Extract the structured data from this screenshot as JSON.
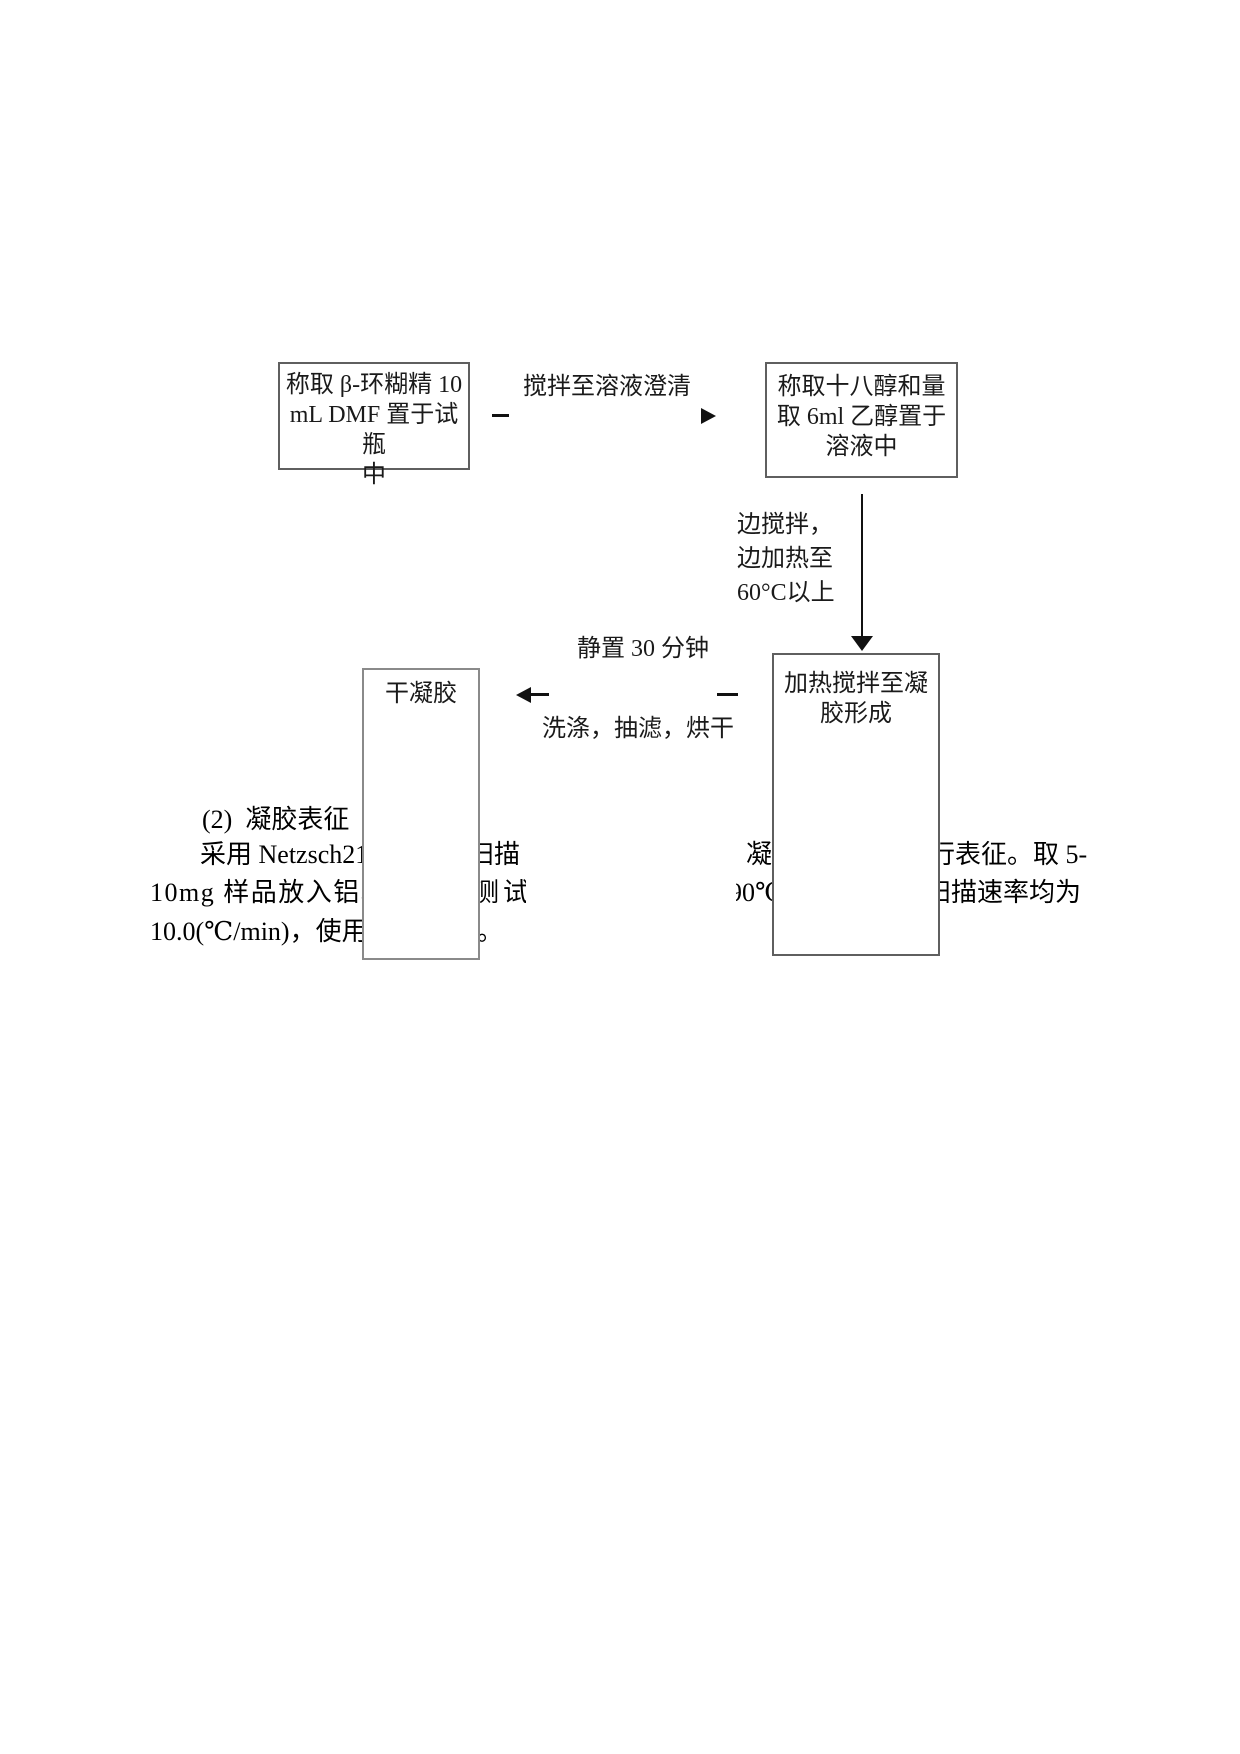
{
  "page": {
    "background": "#ffffff",
    "text_color": "#000000",
    "box_border_color": "#5f5f5f",
    "arrow_color": "#111111"
  },
  "flow": {
    "box1": {
      "text": "称取 β-环糊精 10\nmL DMF 置于试瓶\n中"
    },
    "label_stir": {
      "text": "搅拌至溶液澄清"
    },
    "box2": {
      "text": "称取十八醇和量\n取 6ml 乙醇置于\n溶液中"
    },
    "label_heat": {
      "text": "边搅拌，\n边加热至\n60°C以上"
    },
    "box3": {
      "text": "加热搅拌至凝\n胶形成"
    },
    "label_rest": {
      "text": "静置 30 分钟"
    },
    "label_wash": {
      "text": "洗涤，抽滤，烘干"
    },
    "box4": {
      "text": "干凝胶"
    }
  },
  "body_text": {
    "heading": "(2)  凝胶表征",
    "line1": {
      "f1": "采用 Netzsch21",
      "f2": "扫描",
      "f3": "凝",
      "f4": "行表征。取 5-"
    },
    "line2": {
      "f1": "10mg 样品放入铝坩",
      "f2": "测试",
      "f3": "90℃",
      "f4": "扫描速率均为"
    },
    "line3": {
      "f1": "10.0(℃/min)，使用",
      "f2": "。"
    }
  }
}
